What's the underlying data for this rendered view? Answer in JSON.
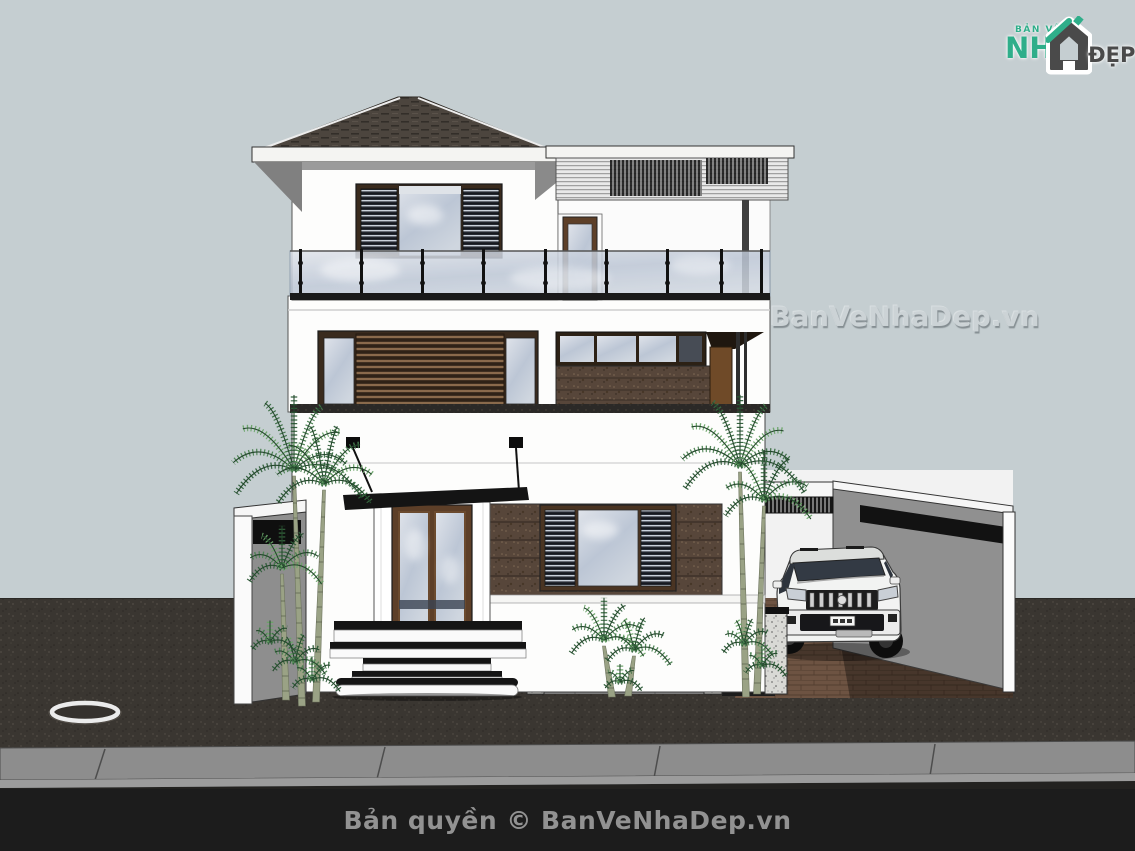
{
  "watermark": {
    "text": "BanVeNhaDep.vn"
  },
  "footer": {
    "copyright": "Bản quyền © BanVeNhaDep.vn"
  },
  "logo": {
    "top_label": "BẢN VẼ",
    "name_prefix": "NH",
    "name_suffix": "ĐẸP",
    "icon": "house-icon"
  },
  "scene": {
    "type": "3d-architecture-render",
    "subject": "Three-storey modern white villa, front elevation",
    "elements": [
      "hip roof with dark shingles",
      "louvered pergola over roof terrace",
      "glass balcony railing with posts",
      "louver-shuttered windows",
      "brown stone cladding panels",
      "double wood-and-glass entry door with black canopy",
      "curved entry steps",
      "basement ramp with granite portal",
      "side carport with white SUV",
      "areca palm trees",
      "white boundary wall",
      "manhole ring in asphalt yard",
      "street curb and road"
    ]
  },
  "palette": {
    "sky": "#c5ced1",
    "asphalt": "#3a3631",
    "curb": "#8d8d8d",
    "bar": "#1c1c1c",
    "wall": "#fdfdfc",
    "roof": "#4c453e",
    "wood": "#5d3f28",
    "stone": "#57463a",
    "paver": "#6d5342",
    "gray-wall": "#909090",
    "glass-hi": "#dfe3ea",
    "glass-lo": "#bcc6d5",
    "leaf": "#3c6b44",
    "logo-green": "#2fae8a",
    "logo-dark": "#4a4a4a",
    "footer-text": "#929292",
    "watermark": "#ccd3d6"
  }
}
